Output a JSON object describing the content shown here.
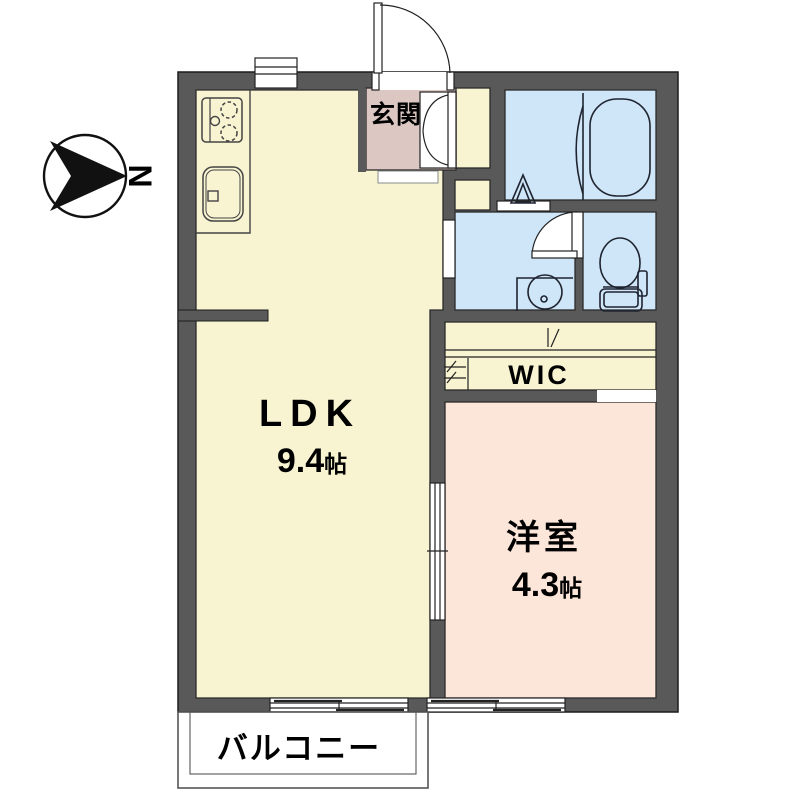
{
  "plan": {
    "compass": {
      "north_label": "N"
    },
    "rooms": {
      "ldk": {
        "label": "LDK",
        "area_value": "9.4",
        "area_unit": "帖"
      },
      "western_room": {
        "label": "洋室",
        "area_value": "4.3",
        "area_unit": "帖"
      },
      "entrance": {
        "label": "玄関"
      },
      "walk_in_closet": {
        "label": "WIC"
      },
      "balcony": {
        "label": "バルコニー"
      }
    },
    "colors": {
      "wall": "#595959",
      "wall_outline": "#1c1c1c",
      "ldk_floor": "#f8f4d1",
      "entrance_floor": "#dcc7c3",
      "wet_area_floor": "#cfe6f8",
      "western_room_floor": "#fce5d9",
      "fixture_line": "#1f2430",
      "balcony_line": "#555555"
    },
    "fixtures": [
      "compass-icon",
      "entrance-door-icon",
      "shoe-closet-icon",
      "kitchen-stove-icon",
      "kitchen-sink-icon",
      "bathtub-icon",
      "bath-folding-door-icon",
      "washbasin-icon",
      "toilet-icon",
      "interior-door-icon",
      "sliding-door-icon",
      "window-icon",
      "balcony"
    ]
  }
}
